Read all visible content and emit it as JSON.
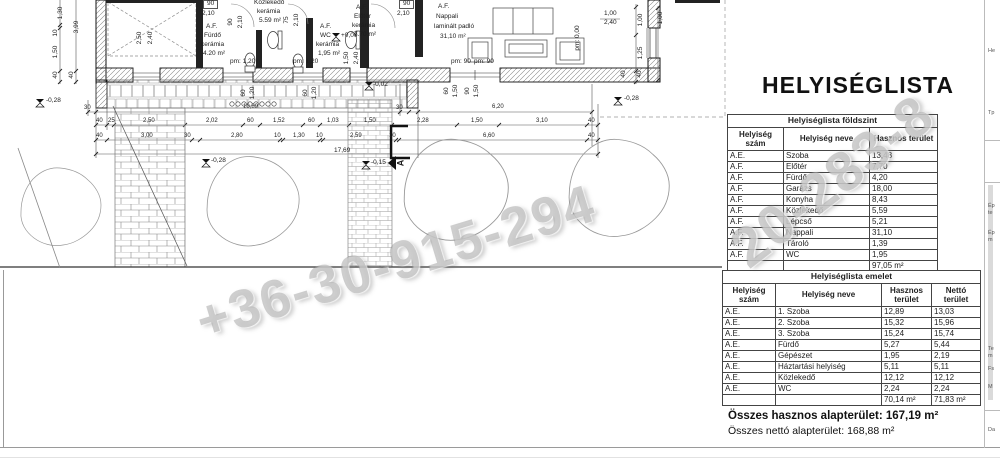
{
  "title": "HELYISÉGLISTA",
  "watermark": {
    "line1": "+36-30-915-294",
    "line2": "20-283-8"
  },
  "tables": {
    "ground": {
      "title": "Helyiséglista földszint",
      "headers": [
        "Helyiség szám",
        "Helyiség neve",
        "Hasznos terület"
      ],
      "rows": [
        [
          "A.E.",
          "Szoba",
          "13,48"
        ],
        [
          "A.F.",
          "Előtér",
          "7,70"
        ],
        [
          "A.F.",
          "Fürdő",
          "4,20"
        ],
        [
          "A.F.",
          "Garázs",
          "18,00"
        ],
        [
          "A.F.",
          "Konyha",
          "8,43"
        ],
        [
          "A.F.",
          "Közlekedő",
          "5,59"
        ],
        [
          "A.F.",
          "Lépcső",
          "5,21"
        ],
        [
          "A.F.",
          "Nappali",
          "31,10"
        ],
        [
          "A.F.",
          "Tároló",
          "1,39"
        ],
        [
          "A.F.",
          "WC",
          "1,95"
        ]
      ],
      "total": "97,05 m²"
    },
    "upper": {
      "title": "Helyiséglista emelet",
      "headers": [
        "Helyiség szám",
        "Helyiség neve",
        "Hasznos terület",
        "Nettó terület"
      ],
      "rows": [
        [
          "A.E.",
          "1. Szoba",
          "12,89",
          "13,03"
        ],
        [
          "A.E.",
          "2. Szoba",
          "15,32",
          "15,96"
        ],
        [
          "A.E.",
          "3. Szoba",
          "15,24",
          "15,74"
        ],
        [
          "A.E.",
          "Fürdő",
          "5,27",
          "5,44"
        ],
        [
          "A.E.",
          "Gépészet",
          "1,95",
          "2,19"
        ],
        [
          "A.E.",
          "Háztartási helyiség",
          "5,11",
          "5,11"
        ],
        [
          "A.E.",
          "Közlekedő",
          "12,12",
          "12,12"
        ],
        [
          "A.E.",
          "WC",
          "2,24",
          "2,24"
        ]
      ],
      "totals": [
        "70,14 m²",
        "71,83 m²"
      ]
    }
  },
  "summary": {
    "hasznos": "Összes hasznos alapterület: 167,19 m²",
    "netto": "Összes nettó alapterület: 168,88 m²"
  },
  "plan": {
    "labels": [
      {
        "t": "A.F.",
        "x": 206,
        "y": 24
      },
      {
        "t": "Fürdő",
        "x": 204,
        "y": 33
      },
      {
        "t": "kerámia",
        "x": 201,
        "y": 42
      },
      {
        "t": "4.20 m²",
        "x": 203,
        "y": 51
      },
      {
        "t": "Közlekedő",
        "x": 254,
        "y": 0
      },
      {
        "t": "kerámia",
        "x": 257,
        "y": 9
      },
      {
        "t": "5.59 m²",
        "x": 259,
        "y": 18
      },
      {
        "t": "A.F.",
        "x": 320,
        "y": 24
      },
      {
        "t": "WC",
        "x": 320,
        "y": 33
      },
      {
        "t": "kerámia",
        "x": 316,
        "y": 42
      },
      {
        "t": "1,95 m²",
        "x": 318,
        "y": 51
      },
      {
        "t": "pm: 1,20",
        "x": 230,
        "y": 59
      },
      {
        "t": "pm: 1,20",
        "x": 293,
        "y": 59
      },
      {
        "t": "A.F.",
        "x": 356,
        "y": 5
      },
      {
        "t": "Előtér",
        "x": 354,
        "y": 14
      },
      {
        "t": "kerámia",
        "x": 352,
        "y": 23
      },
      {
        "t": "7.70 m²",
        "x": 354,
        "y": 32
      },
      {
        "t": "A.F.",
        "x": 438,
        "y": 4
      },
      {
        "t": "Nappali",
        "x": 436,
        "y": 14
      },
      {
        "t": "laminált padló",
        "x": 434,
        "y": 24
      },
      {
        "t": "31,10 m²",
        "x": 440,
        "y": 34
      },
      {
        "t": "+0,00",
        "x": 341,
        "y": 33
      },
      {
        "t": "-0,02",
        "x": 373,
        "y": 82
      },
      {
        "t": "-0,28",
        "x": 46,
        "y": 98
      },
      {
        "t": "-0,28",
        "x": 624,
        "y": 96
      },
      {
        "t": "-0,28",
        "x": 211,
        "y": 158
      },
      {
        "t": "-0,15",
        "x": 371,
        "y": 160
      },
      {
        "t": "pm: 90",
        "x": 451,
        "y": 59
      },
      {
        "t": "pm: 90",
        "x": 474,
        "y": 59
      },
      {
        "t": "17,69",
        "x": 334,
        "y": 148
      },
      {
        "t": "90",
        "x": 203,
        "y": 0,
        "box": 1
      },
      {
        "t": "2,10",
        "x": 202,
        "y": 11
      },
      {
        "t": "90",
        "x": 399,
        "y": 0,
        "box": 1
      },
      {
        "t": "2,10",
        "x": 397,
        "y": 11
      },
      {
        "t": "1,00",
        "x": 604,
        "y": 11
      },
      {
        "t": "2,40",
        "x": 604,
        "y": 20
      },
      {
        "t": "90",
        "x": 231,
        "y": 22,
        "r": -90
      },
      {
        "t": "2,10",
        "x": 241,
        "y": 22,
        "r": -90
      },
      {
        "t": "75",
        "x": 287,
        "y": 20,
        "r": -90
      },
      {
        "t": "2,10",
        "x": 297,
        "y": 20,
        "r": -90
      },
      {
        "t": "2,50",
        "x": 140,
        "y": 38,
        "r": -90
      },
      {
        "t": "2,40",
        "x": 151,
        "y": 38,
        "r": -90
      },
      {
        "t": "1,50",
        "x": 347,
        "y": 58,
        "r": -90
      },
      {
        "t": "2,40",
        "x": 357,
        "y": 58,
        "r": -90
      },
      {
        "t": "1,30",
        "x": 61,
        "y": 13,
        "r": -90
      },
      {
        "t": "3,99",
        "x": 77,
        "y": 27,
        "r": -90
      },
      {
        "t": "10",
        "x": 56,
        "y": 33,
        "r": -90
      },
      {
        "t": "1,50",
        "x": 56,
        "y": 52,
        "r": -90
      },
      {
        "t": "40",
        "x": 56,
        "y": 75,
        "r": -90
      },
      {
        "t": "40",
        "x": 72,
        "y": 75,
        "r": -90
      },
      {
        "t": "1,00",
        "x": 641,
        "y": 20,
        "r": -90
      },
      {
        "t": "1,25",
        "x": 641,
        "y": 53,
        "r": -90
      },
      {
        "t": "40",
        "x": 624,
        "y": 74,
        "r": -90
      },
      {
        "t": "40",
        "x": 640,
        "y": 74,
        "r": -90
      },
      {
        "t": "1,00",
        "x": 661,
        "y": 18,
        "r": -90
      },
      {
        "t": "pm: 0,00",
        "x": 578,
        "y": 38,
        "r": -90
      },
      {
        "t": "60",
        "x": 447,
        "y": 91,
        "r": -90
      },
      {
        "t": "1,50",
        "x": 456,
        "y": 91,
        "r": -90
      },
      {
        "t": "90",
        "x": 468,
        "y": 91,
        "r": -90
      },
      {
        "t": "1,50",
        "x": 477,
        "y": 91,
        "r": -90
      },
      {
        "t": "60",
        "x": 244,
        "y": 93,
        "r": -90
      },
      {
        "t": "1,20",
        "x": 253,
        "y": 93,
        "r": -90
      },
      {
        "t": "60",
        "x": 306,
        "y": 93,
        "r": -90
      },
      {
        "t": "1,20",
        "x": 315,
        "y": 93,
        "r": -90
      },
      {
        "t": "A",
        "x": 401,
        "y": 163,
        "r": -90,
        "s": 9,
        "b": 1
      },
      {
        "t": "30",
        "x": 84,
        "y": 105,
        "s": 6
      },
      {
        "t": "10,89",
        "x": 243,
        "y": 104,
        "s": 6
      },
      {
        "t": "30",
        "x": 396,
        "y": 105,
        "s": 6
      },
      {
        "t": "6,20",
        "x": 492,
        "y": 104,
        "s": 6
      },
      {
        "t": "40",
        "x": 96,
        "y": 118,
        "s": 6
      },
      {
        "t": "25",
        "x": 108,
        "y": 118,
        "s": 6
      },
      {
        "t": "2,50",
        "x": 143,
        "y": 118,
        "s": 6
      },
      {
        "t": "2,02",
        "x": 206,
        "y": 118,
        "s": 6
      },
      {
        "t": "60",
        "x": 247,
        "y": 118,
        "s": 6
      },
      {
        "t": "1,52",
        "x": 273,
        "y": 118,
        "s": 6
      },
      {
        "t": "60",
        "x": 308,
        "y": 118,
        "s": 6
      },
      {
        "t": "1,03",
        "x": 327,
        "y": 118,
        "s": 6
      },
      {
        "t": "1,50",
        "x": 364,
        "y": 118,
        "s": 6
      },
      {
        "t": "2,28",
        "x": 417,
        "y": 118,
        "s": 6
      },
      {
        "t": "1,50",
        "x": 471,
        "y": 118,
        "s": 6
      },
      {
        "t": "3,10",
        "x": 536,
        "y": 118,
        "s": 6
      },
      {
        "t": "40",
        "x": 588,
        "y": 118,
        "s": 6
      },
      {
        "t": "40",
        "x": 96,
        "y": 133,
        "s": 6
      },
      {
        "t": "3,00",
        "x": 141,
        "y": 133,
        "s": 6
      },
      {
        "t": "30",
        "x": 184,
        "y": 133,
        "s": 6
      },
      {
        "t": "2,80",
        "x": 231,
        "y": 133,
        "s": 6
      },
      {
        "t": "10",
        "x": 274,
        "y": 133,
        "s": 6
      },
      {
        "t": "1,30",
        "x": 293,
        "y": 133,
        "s": 6
      },
      {
        "t": "10",
        "x": 316,
        "y": 133,
        "s": 6
      },
      {
        "t": "2,59",
        "x": 350,
        "y": 133,
        "s": 6
      },
      {
        "t": "10",
        "x": 389,
        "y": 133,
        "s": 6
      },
      {
        "t": "6,60",
        "x": 483,
        "y": 133,
        "s": 6
      },
      {
        "t": "40",
        "x": 588,
        "y": 133,
        "s": 6
      }
    ]
  },
  "side_panel": {
    "fragments": [
      {
        "t": "He",
        "y": 48
      },
      {
        "t": "Tp",
        "y": 110
      },
      {
        "t": "Ép",
        "y": 203
      },
      {
        "t": "te",
        "y": 210
      },
      {
        "t": "Ép",
        "y": 230
      },
      {
        "t": "m",
        "y": 237
      },
      {
        "t": "Te",
        "y": 346
      },
      {
        "t": "m",
        "y": 353
      },
      {
        "t": "Fs",
        "y": 366
      },
      {
        "t": "M",
        "y": 384
      },
      {
        "t": "Da",
        "y": 427
      }
    ]
  }
}
